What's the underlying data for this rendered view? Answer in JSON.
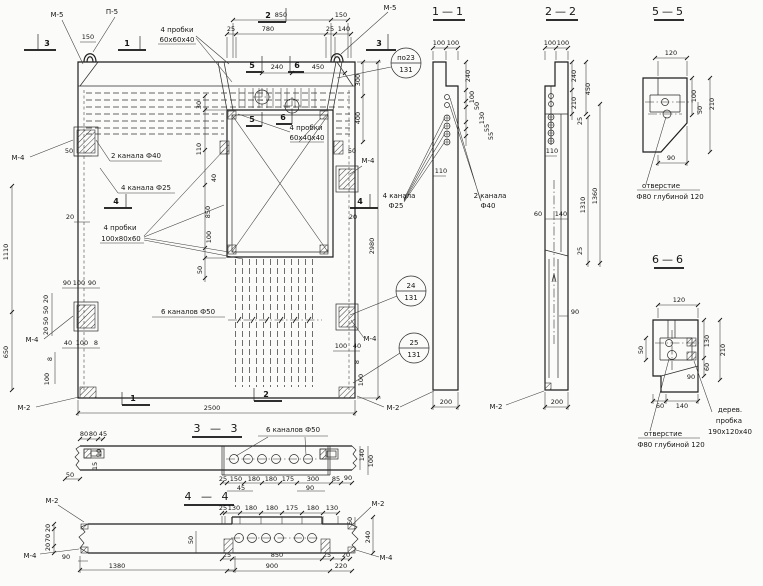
{
  "views": {
    "main": {
      "marks": {
        "m5_left": "М-5",
        "p5": "П-5",
        "m5_right": "М-5",
        "m4_left_upper": "М-4",
        "m4_left_lower": "М-4",
        "m4_right_upper": "М-4",
        "m4_right_lower": "М-4",
        "m2_bottom_left": "М-2",
        "m2_bottom_right": "М-2"
      },
      "cut_labels": {
        "c1": "1",
        "c2": "2",
        "c3": "3",
        "c4": "4",
        "c5": "5",
        "c6": "6"
      },
      "callouts": {
        "po23": "по23",
        "po23_sheet": "131",
        "d24": "24",
        "d24_sheet": "131",
        "d25": "25",
        "d25_sheet": "131"
      },
      "annotations": {
        "plugs_top_line1": "4 пробки",
        "plugs_top_line2": "60х60х40",
        "channels_2": "2 канала Ф40",
        "channels_4": "4 канала Ф25",
        "plugs_side_line1": "4 пробки",
        "plugs_side_line2": "100х80х60",
        "channels_6": "6 каналов Ф50",
        "plugs_niche_line1": "4 пробки",
        "plugs_niche_line2": "60х40х40"
      },
      "dims": {
        "top_850": "850",
        "top_150_right": "150",
        "top_25_left": "25",
        "top_780": "780",
        "top_25_right": "25",
        "top_140": "140",
        "top_150_left": "150",
        "mid_240": "240",
        "mid_450": "450",
        "right_300": "300",
        "right_400": "400",
        "right_50": "50",
        "right_20": "20",
        "right_2980": "2980",
        "right_100": "100",
        "right_40": "40",
        "right_8": "8",
        "right_100b": "100",
        "left_1110": "1110",
        "left_650": "650",
        "left_50": "50",
        "left_20": "20",
        "left_90a": "90",
        "left_100": "100",
        "left_90b": "90",
        "left_20a": "20",
        "left_50a": "50",
        "left_50b": "50",
        "left_20b": "20",
        "left_40": "40",
        "left_100c": "100",
        "left_8": "8",
        "left_8b": "8",
        "left_100d": "100",
        "niche_30": "30",
        "niche_110": "110",
        "niche_40": "40",
        "niche_850": "850",
        "niche_100": "100",
        "niche_50": "50",
        "bottom_2500": "2500"
      }
    },
    "s11": {
      "title": "1—1",
      "annotations": {
        "ch4_line1": "4 канала",
        "ch4_line2": "Ф25",
        "ch2_line1": "2 канала",
        "ch2_line2": "Ф40"
      },
      "dims": {
        "top_100a": "100",
        "top_100b": "100",
        "r_240": "240",
        "r_100": "100",
        "r_50": "50",
        "r_130": "130",
        "r_55a": "55",
        "r_55b": "55",
        "inner_110": "110",
        "bottom_200": "200"
      }
    },
    "s22": {
      "title": "2—2",
      "dims": {
        "top_100a": "100",
        "top_100b": "100",
        "r_240": "240",
        "r_210": "210",
        "r_450": "450",
        "r_25a": "25",
        "inner_110": "110",
        "inner_60": "60",
        "inner_140": "140",
        "mid_90": "90",
        "r_1310": "1310",
        "r_1360": "1360",
        "r_25b": "25",
        "bottom_200": "200"
      },
      "marks": {
        "m2": "М-2"
      }
    },
    "s55": {
      "title": "5—5",
      "dims": {
        "top_120": "120",
        "r_100": "100",
        "r_50": "50",
        "r_210": "210",
        "bottom_90": "90"
      },
      "annotations": {
        "hole_line1": "отверстие",
        "hole_line2": "Ф80 глубиной 120"
      }
    },
    "s66": {
      "title": "6—6",
      "dims": {
        "top_120": "120",
        "l_50": "50",
        "r_130": "130",
        "r_210": "210",
        "r_60": "60",
        "r_90": "90",
        "b_60": "60",
        "b_140": "140"
      },
      "annotations": {
        "hole_line1": "отверстие",
        "hole_line2": "Ф80 глубиной 120",
        "plug_line1": "дерев.",
        "plug_line2": "пробка",
        "plug_line3": "190х120х40"
      }
    },
    "s33": {
      "title": "3 — 3",
      "annotations": {
        "channels": "6 каналов Ф50"
      },
      "dims": {
        "tl_80a": "80",
        "tl_80b": "80",
        "tl_45": "45",
        "l_50": "50",
        "l_90": "90",
        "l_15": "15",
        "b_25": "25",
        "b_150": "150",
        "b_180a": "180",
        "b_180b": "180",
        "b_175": "175",
        "b_300": "300",
        "b_85": "85",
        "b_45": "45",
        "b_90": "90",
        "r_90": "90",
        "r_140": "140",
        "r_100": "100"
      }
    },
    "s44": {
      "title": "4 — 4",
      "dims": {
        "t_25": "25",
        "t_130a": "130",
        "t_180a": "180",
        "t_180b": "180",
        "t_175": "175",
        "t_180c": "180",
        "t_130b": "130",
        "l_20a": "20",
        "l_70": "70",
        "l_20b": "20",
        "l_90": "90",
        "b_1380": "1380",
        "mid_50": "50",
        "b_25a": "25",
        "b_850": "850",
        "b_25b": "25",
        "b_900": "900",
        "b_20": "20",
        "b_220": "220",
        "r_60": "60",
        "r_240": "240"
      },
      "marks": {
        "m2_left": "М-2",
        "m2_right": "М-2",
        "m4_left": "М-4",
        "m4_right": "М-4"
      }
    }
  }
}
